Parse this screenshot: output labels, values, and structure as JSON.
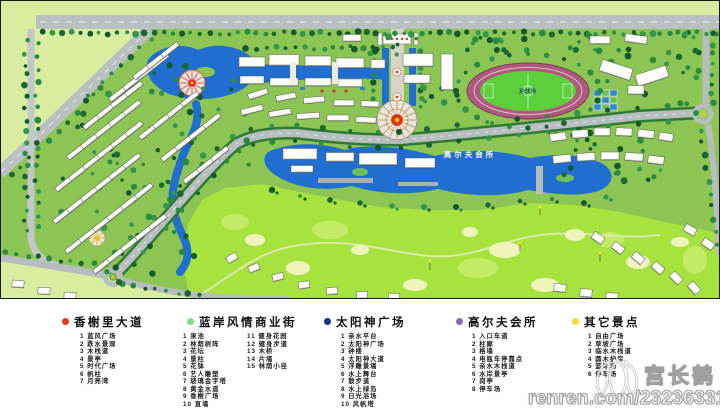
{
  "map": {
    "labels": {
      "stadium": "足球场",
      "golf_club": "高尔夫会所"
    }
  },
  "legend": {
    "groups": [
      {
        "name": "香榭里大道",
        "color": "#e03a1c",
        "items": [
          "1 蓝风广场",
          "2 跌水景观",
          "3 木栈道",
          "4 景亭",
          "5 时代广场",
          "6 帆柱",
          "7 月亮湾"
        ]
      },
      {
        "name": "蓝岸风情商业街",
        "color": "#82d992",
        "items": [
          "1 泉池",
          "2 林荫树阵",
          "3 花坛",
          "4 景柱",
          "5 花钵",
          "6 艺人雕塑",
          "7 玻璃金字塔",
          "8 黄金水道",
          "9 香榭广场",
          "10 直墙",
          "11 健身花园",
          "12 健身步道",
          "13 木桥",
          "14 片墙",
          "15 林荫小径"
        ]
      },
      {
        "name": "太阳神广场",
        "color": "#16328e",
        "items": [
          "1 亲水平台",
          "2 太阳神广场",
          "3 钟楼",
          "4 太阳神大道",
          "5 浮雕景墙",
          "6 水上舞台",
          "7 散步道",
          "8 水上绿岛",
          "9 日光浴场",
          "10 风帆塔"
        ]
      },
      {
        "name": "高尔夫会所",
        "color": "#8a68b8",
        "items": [
          "1 入口车道",
          "2 柱廊",
          "3 格墙",
          "4 电瓶车停靠点",
          "5 亲水木栈道",
          "6 水岸景亭",
          "7 岗亭",
          "8 停车场"
        ]
      },
      {
        "name": "其它景点",
        "color": "#e8e435",
        "items": [
          "1 自由广场",
          "2 草坡广场",
          "3 临水木栈道",
          "4 圆木护岸",
          "5 篮球场",
          "6 停车场"
        ]
      }
    ]
  },
  "watermark": {
    "name": "宫长鹤",
    "url": "renren.com/232363316"
  }
}
